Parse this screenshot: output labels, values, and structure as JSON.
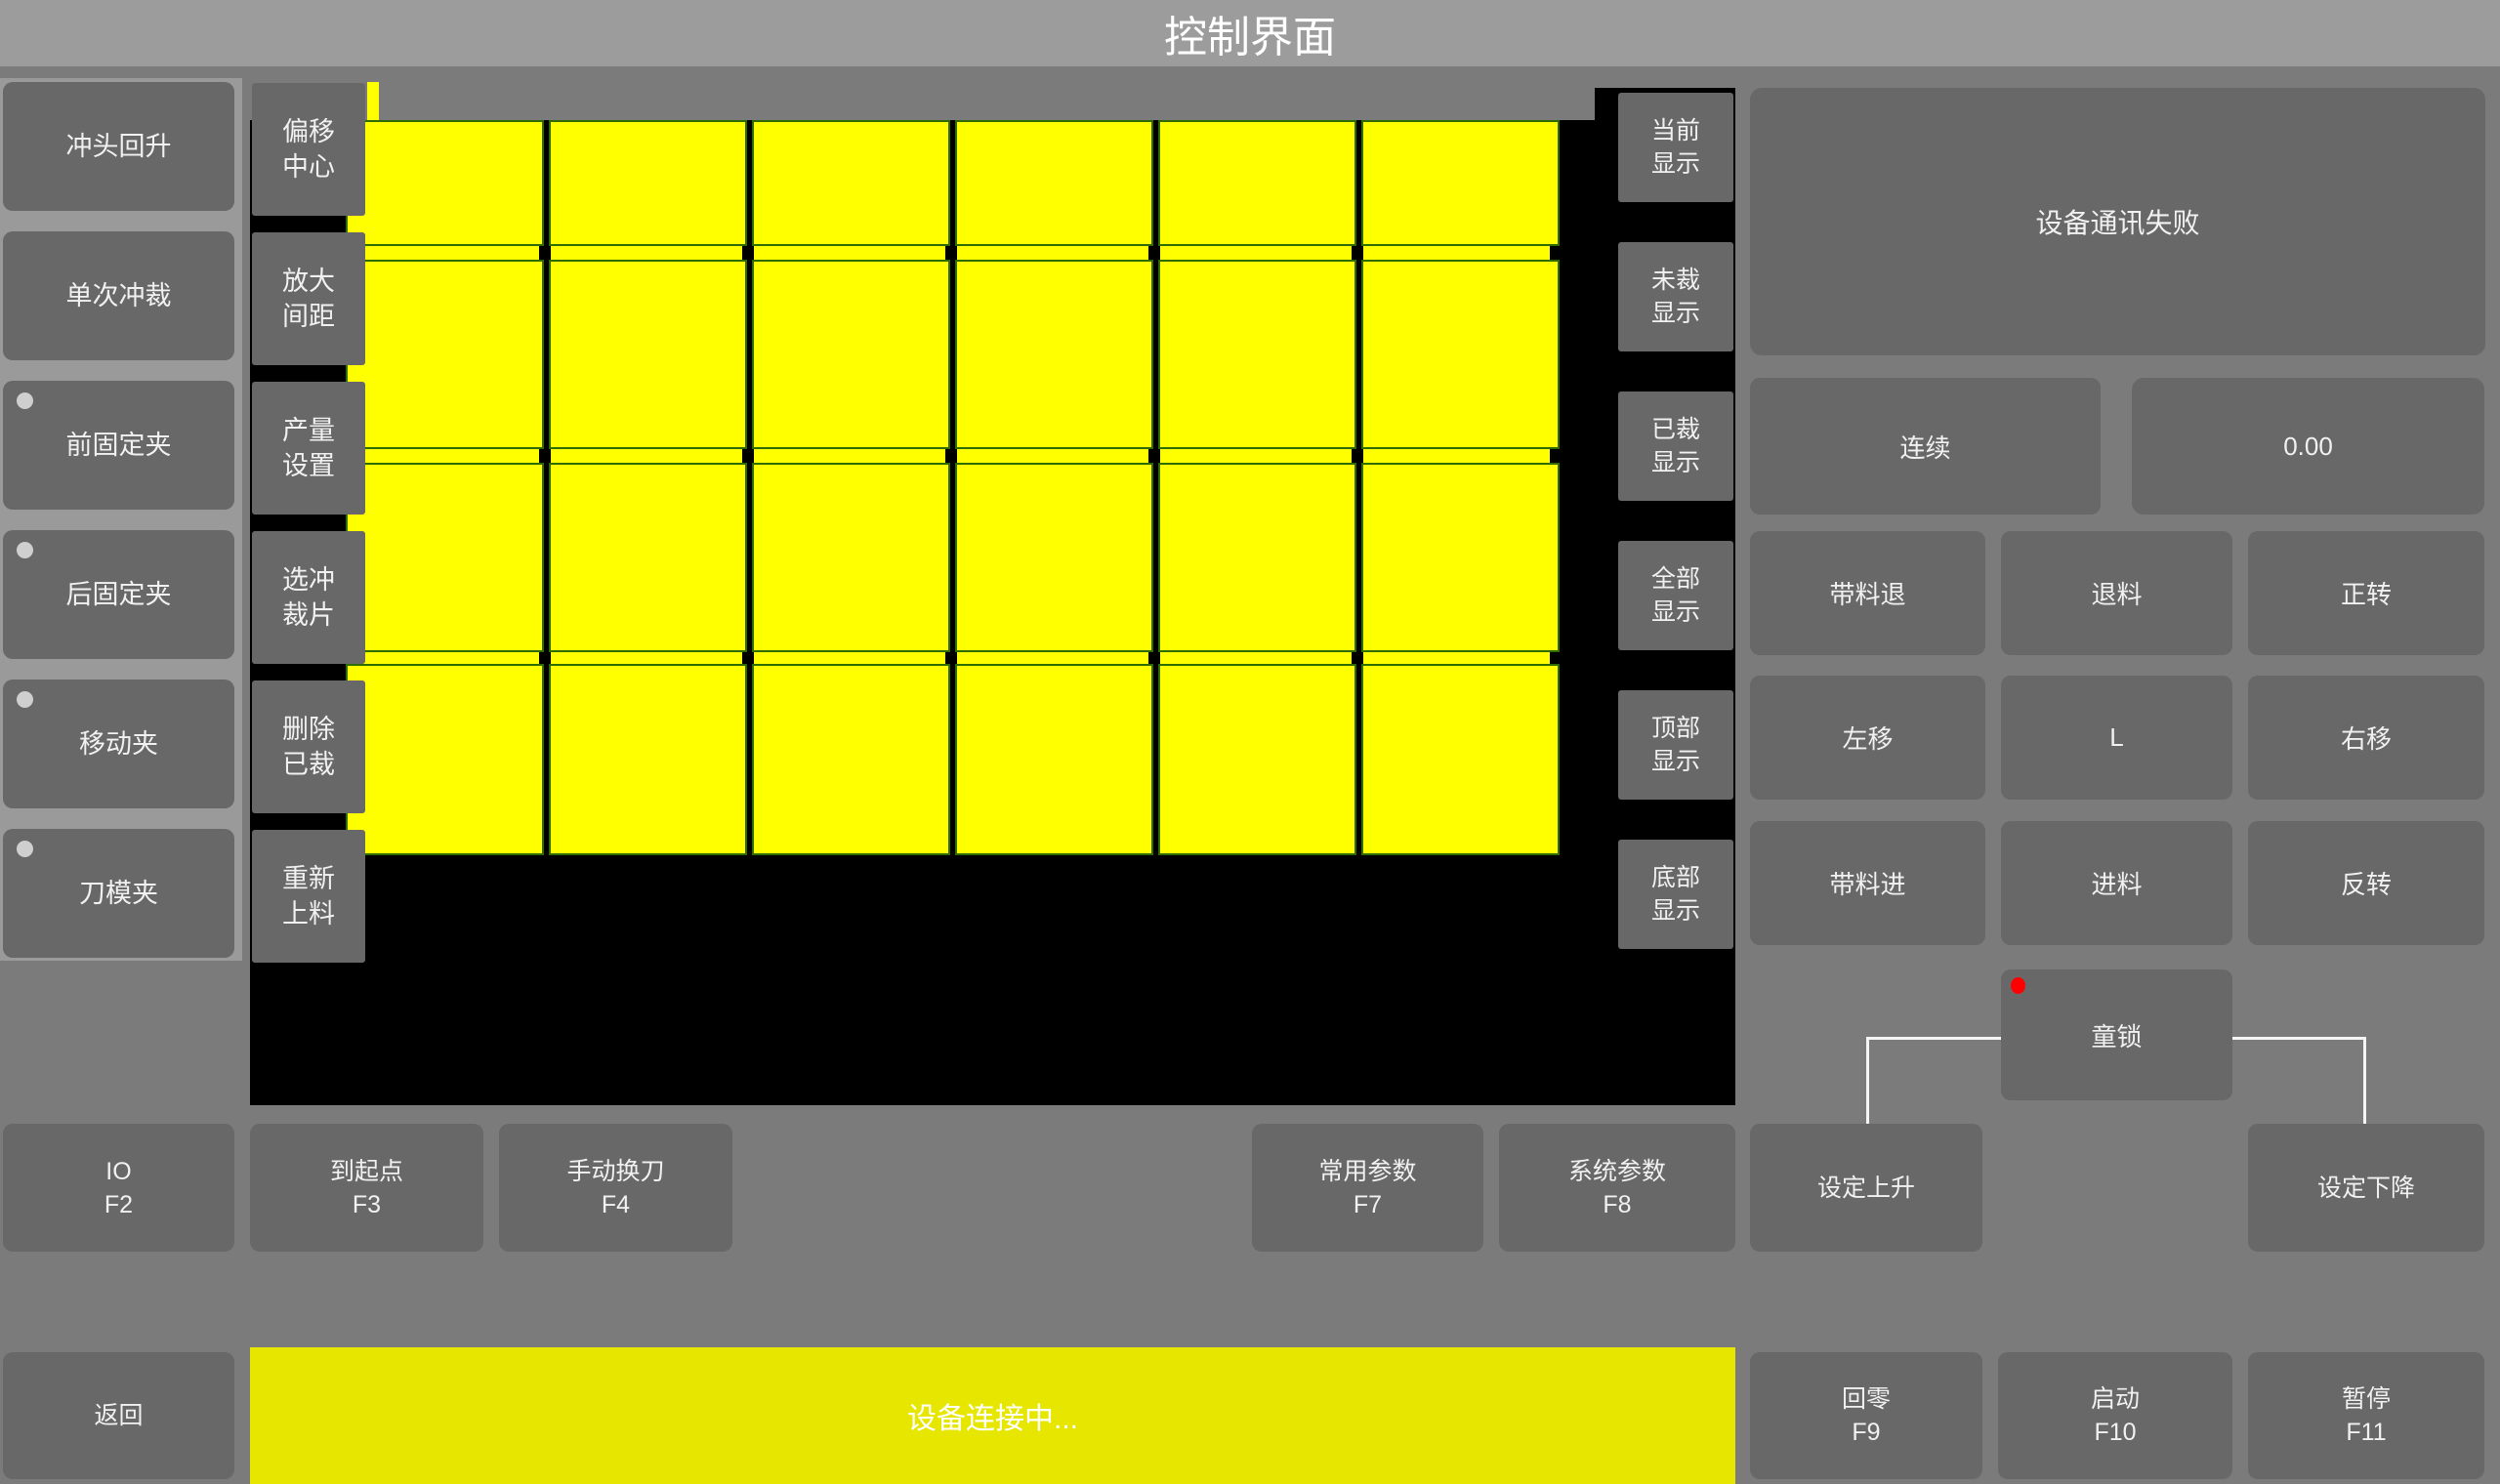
{
  "title_bar": {
    "title": "控制界面"
  },
  "left_panel": {
    "buttons": [
      {
        "label": "冲头回升",
        "indicator": false
      },
      {
        "label": "单次冲裁",
        "indicator": false
      },
      {
        "label": "前固定夹",
        "indicator": true
      },
      {
        "label": "后固定夹",
        "indicator": true
      },
      {
        "label": "移动夹",
        "indicator": true
      },
      {
        "label": "刀模夹",
        "indicator": true
      }
    ]
  },
  "tool_panel": {
    "buttons": [
      {
        "lines": [
          "偏移",
          "中心"
        ]
      },
      {
        "lines": [
          "放大",
          "间距"
        ]
      },
      {
        "lines": [
          "产量",
          "设置"
        ]
      },
      {
        "lines": [
          "选冲",
          "裁片"
        ]
      },
      {
        "lines": [
          "删除",
          "已裁"
        ]
      },
      {
        "lines": [
          "重新",
          "上料"
        ]
      }
    ]
  },
  "display_panel": {
    "buttons": [
      {
        "lines": [
          "当前",
          "显示"
        ]
      },
      {
        "lines": [
          "未裁",
          "显示"
        ]
      },
      {
        "lines": [
          "已裁",
          "显示"
        ]
      },
      {
        "lines": [
          "全部",
          "显示"
        ]
      },
      {
        "lines": [
          "顶部",
          "显示"
        ]
      },
      {
        "lines": [
          "底部",
          "显示"
        ]
      }
    ]
  },
  "canvas": {
    "grid": {
      "rows": 4,
      "cols": 6,
      "piece_color": "#ffff00",
      "piece_border_color": "#2e6b00",
      "background": "#000000"
    }
  },
  "right_panel": {
    "message": "设备通讯失败",
    "mode_button": "连续",
    "value_display": "0.00",
    "jog_buttons": [
      [
        "带料退",
        "退料",
        "正转"
      ],
      [
        "左移",
        "L",
        "右移"
      ],
      [
        "带料进",
        "进料",
        "反转"
      ]
    ],
    "lock_button": {
      "label": "童锁",
      "alarm_dot_color": "#ff0000"
    }
  },
  "function_row": {
    "buttons": [
      {
        "label": "IO",
        "fkey": "F2"
      },
      {
        "label": "到起点",
        "fkey": "F3"
      },
      {
        "label": "手动换刀",
        "fkey": "F4"
      },
      {
        "label": "常用参数",
        "fkey": "F7"
      },
      {
        "label": "系统参数",
        "fkey": "F8"
      },
      {
        "label": "设定上升",
        "fkey": ""
      },
      {
        "label": "设定下降",
        "fkey": ""
      }
    ]
  },
  "bottom_bar": {
    "back_button": "返回",
    "status_text": "设备连接中...",
    "buttons": [
      {
        "label": "回零",
        "fkey": "F9"
      },
      {
        "label": "启动",
        "fkey": "F10"
      },
      {
        "label": "暂停",
        "fkey": "F11"
      }
    ]
  },
  "colors": {
    "piece_yellow": "#ffff00",
    "status_yellow": "#e6e600",
    "alarm_red": "#ff0000",
    "title_bar_bg": "#9c9c9c",
    "page_bg": "#7b7b7b",
    "left_panel_bg": "#9a9a9a",
    "button_bg": "#686868",
    "canvas_bg": "#000000"
  }
}
